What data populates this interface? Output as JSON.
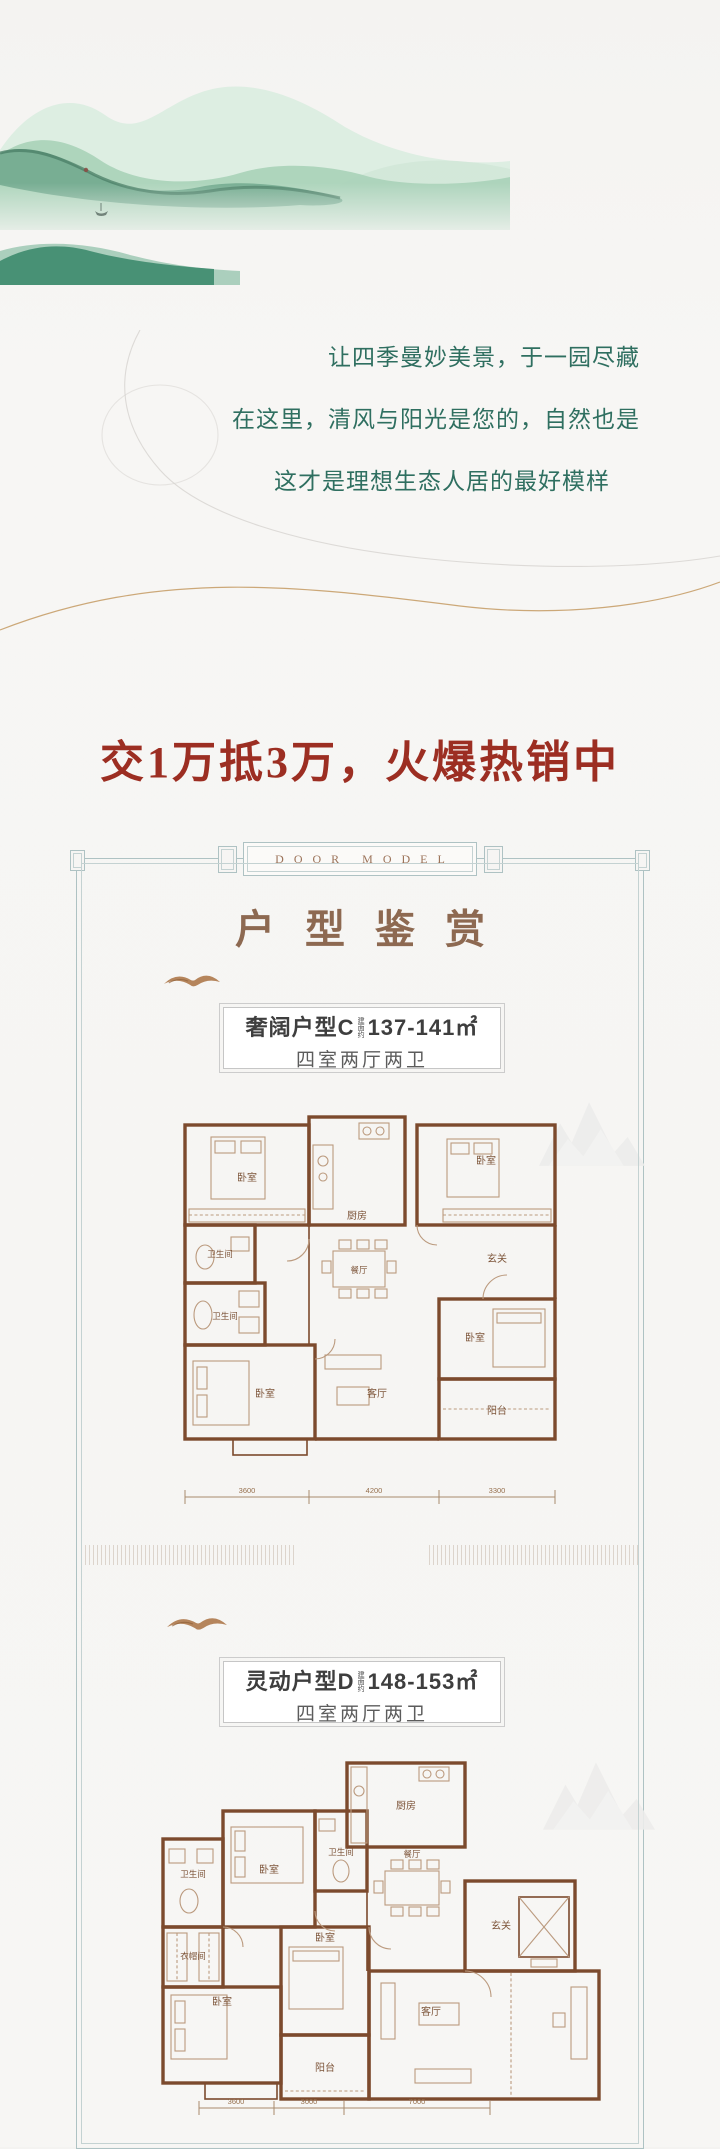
{
  "colors": {
    "tagline_green": "#2f6f60",
    "promo_red": "#9c2e22",
    "frame_border": "#aec2c3",
    "title_brown": "#8d6951",
    "wall_brown": "#7c4a2d",
    "mountain_green": "#8fc2a4"
  },
  "icons": {
    "mountain_painting": "ink-wash-mountains",
    "bird": "flying-bird-brushstroke",
    "faint_peaks": "faint-mountain-watermark",
    "curves": "decorative-flow-lines"
  },
  "taglines": {
    "line1": "让四季曼妙美景，于一园尽藏",
    "line2": "在这里，清风与阳光是您的，自然也是",
    "line3": "这才是理想生态人居的最好模样"
  },
  "promo": {
    "headline": "交1万抵3万，火爆热销中"
  },
  "frame": {
    "plaque": "DOOR MODEL",
    "title": "户型鉴赏"
  },
  "plan_c": {
    "name": "奢阔户型C",
    "area_prefix": "建面约",
    "area": "137-141㎡",
    "spec": "四室两厅两卫",
    "rooms": [
      "卧室",
      "厨房",
      "卧室",
      "卫生间",
      "餐厅",
      "卫生间",
      "玄关",
      "卧室",
      "客厅",
      "卧室",
      "阳台"
    ],
    "dims": [
      "3600",
      "4200",
      "3300"
    ]
  },
  "plan_d": {
    "name": "灵动户型D",
    "area_prefix": "建面约",
    "area": "148-153㎡",
    "spec": "四室两厅两卫",
    "rooms": [
      "厨房",
      "卧室",
      "卫生间",
      "卫生间",
      "餐厅",
      "玄关",
      "衣帽间",
      "卧室",
      "卧室",
      "客厅",
      "阳台"
    ],
    "dims": [
      "3600",
      "3000",
      "7000"
    ]
  }
}
